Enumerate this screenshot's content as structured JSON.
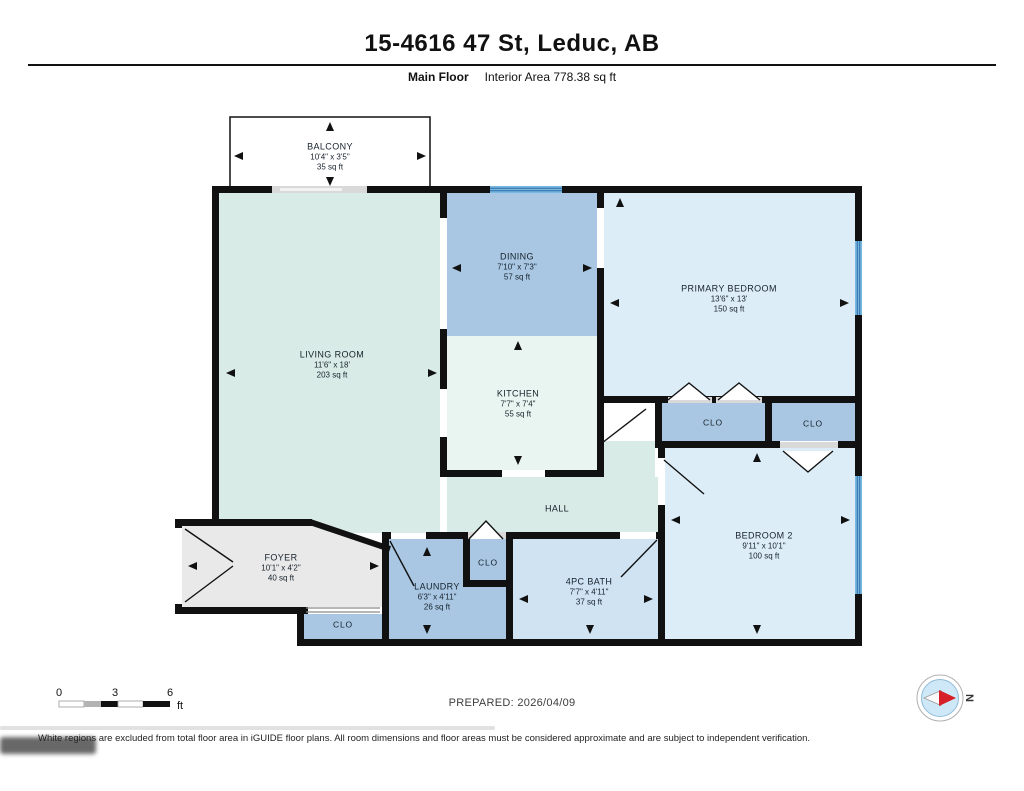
{
  "header": {
    "title": "15-4616 47 St, Leduc, AB",
    "floor_label": "Main Floor",
    "interior_area": "Interior Area 778.38 sq ft"
  },
  "rooms": {
    "balcony": {
      "name": "BALCONY",
      "dims": "10'4\" x 3'5\"",
      "area": "35 sq ft"
    },
    "living": {
      "name": "LIVING ROOM",
      "dims": "11'6\" x 18'",
      "area": "203 sq ft"
    },
    "dining": {
      "name": "DINING",
      "dims": "7'10\" x 7'3\"",
      "area": "57 sq ft"
    },
    "kitchen": {
      "name": "KITCHEN",
      "dims": "7'7\" x 7'4\"",
      "area": "55 sq ft"
    },
    "primary_bedroom": {
      "name": "PRIMARY BEDROOM",
      "dims": "13'6\" x 13'",
      "area": "150 sq ft"
    },
    "hall": {
      "name": "HALL"
    },
    "foyer": {
      "name": "FOYER",
      "dims": "10'1\" x 4'2\"",
      "area": "40 sq ft"
    },
    "laundry": {
      "name": "LAUNDRY",
      "dims": "6'3\" x 4'11\"",
      "area": "26 sq ft"
    },
    "bath": {
      "name": "4PC BATH",
      "dims": "7'7\" x 4'11\"",
      "area": "37 sq ft"
    },
    "bedroom2": {
      "name": "BEDROOM 2",
      "dims": "9'11\" x 10'1\"",
      "area": "100 sq ft"
    },
    "closet_primary_left": {
      "name": "CLO"
    },
    "closet_primary_right": {
      "name": "CLO"
    },
    "closet_hall": {
      "name": "CLO"
    },
    "closet_foyer": {
      "name": "CLO"
    }
  },
  "scale_bar": {
    "tick0": "0",
    "tick3": "3",
    "tick6": "6",
    "unit": "ft"
  },
  "compass": {
    "north_label": "N"
  },
  "footer": {
    "prepared": "PREPARED: 2026/04/09",
    "disclaimer": "White regions are excluded from total floor area in iGUIDE floor plans. All room dimensions and floor areas must be considered approximate and are subject to independent verification."
  },
  "colors": {
    "wall": "#111111",
    "room_blue_light": "#ddedf7",
    "room_blue_medium": "#a9c7e2",
    "room_mint": "#d8ebe6",
    "room_pale": "#e9f5f0",
    "bath_blue": "#cfe3f2",
    "excluded_gray": "#e9e9e9",
    "window_blue": "#79b7e3",
    "window_stripe": "#2e6da4",
    "compass_red": "#d61f26",
    "compass_fill": "#cfe8f7"
  }
}
